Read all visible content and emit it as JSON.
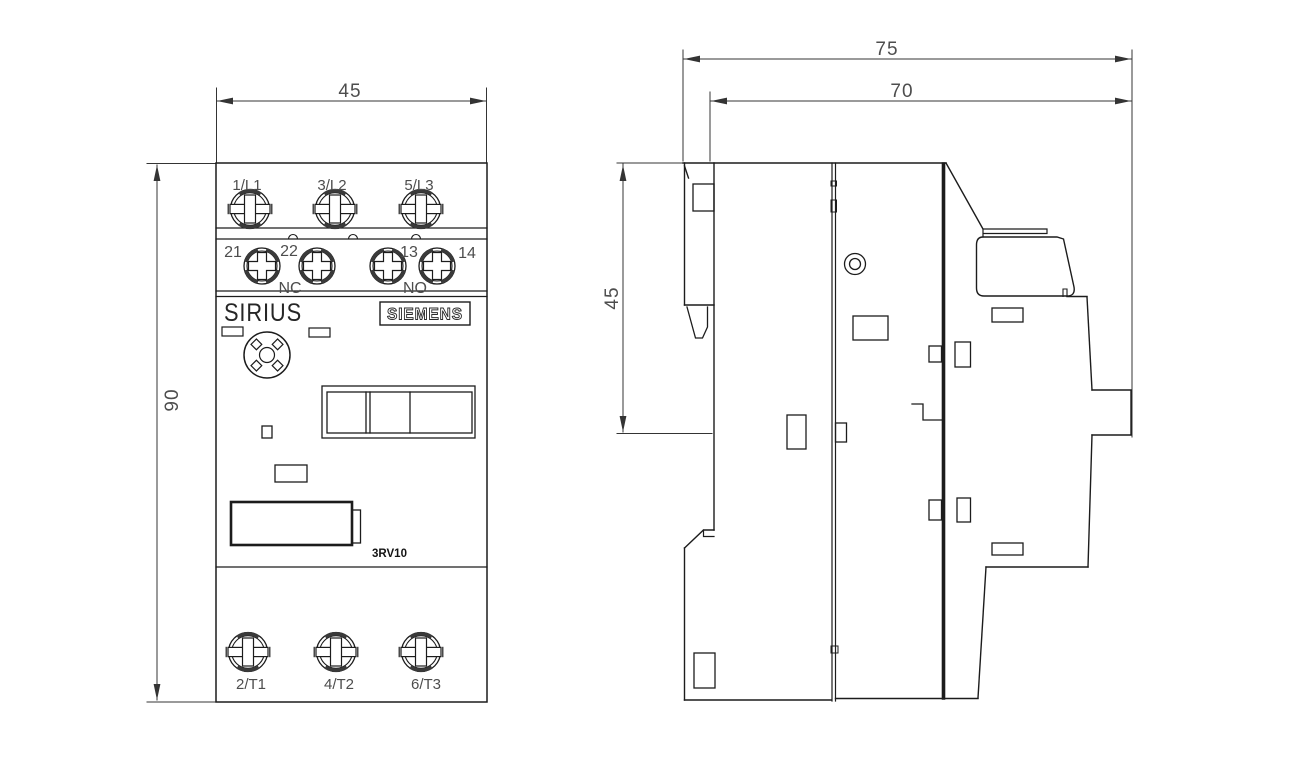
{
  "drawing_type": "dimensional drawing",
  "front_view": {
    "width_dim": "45",
    "height_dim": "90",
    "line_terminals": [
      "1/L1",
      "3/L2",
      "5/L3"
    ],
    "aux_terminal_numbers": [
      "21",
      "22",
      "13",
      "14"
    ],
    "aux_contact_nc": "NC",
    "aux_contact_no": "NO",
    "brand": "SIRIUS",
    "manufacturer": "SIEMENS",
    "model": "3RV10",
    "load_terminals": [
      "2/T1",
      "4/T2",
      "6/T3"
    ]
  },
  "side_view": {
    "overall_depth_dim": "75",
    "body_depth_dim": "70",
    "upper_height_dim": "45"
  },
  "colors": {
    "line": "#1c1c1c",
    "dim_line": "#343434",
    "text": "#4d4d4d",
    "background": "#ffffff"
  }
}
